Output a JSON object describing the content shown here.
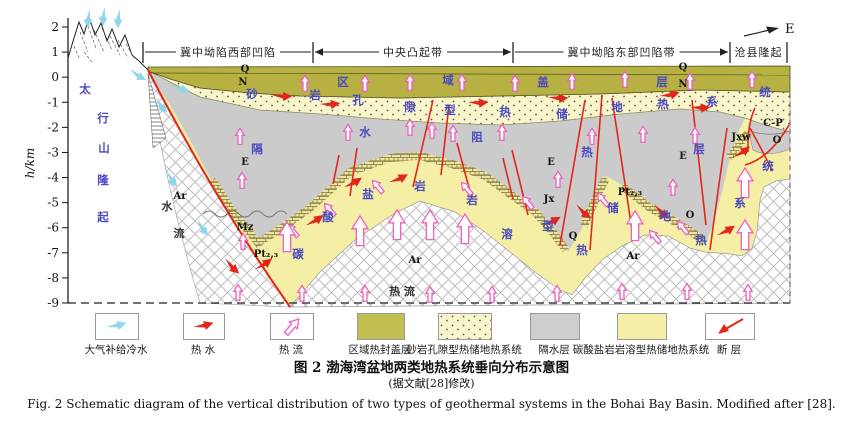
{
  "figure": {
    "caption_cn": "图 2  渤海湾盆地两类地热系统垂向分布示意图",
    "caption_note": "(据文献[28]修改)",
    "caption_en": "Fig. 2   Schematic diagram of the vertical distribution of two types of geothermal systems in the Bohai Bay Basin. Modified after [28]."
  },
  "axis": {
    "label": "h/km",
    "ticks": [
      "2",
      "1",
      "0",
      "-1",
      "-2",
      "-3",
      "-4",
      "-5",
      "-6",
      "-7",
      "-8",
      "-9"
    ]
  },
  "compass_label": "E",
  "zones": [
    {
      "label": "冀中坳陷西部凹陷",
      "x1": 143,
      "x2": 313,
      "arrow_left": false,
      "arrow_right": false
    },
    {
      "label": "中央凸起带",
      "x1": 313,
      "x2": 513,
      "arrow_left": true,
      "arrow_right": true
    },
    {
      "label": "冀中坳陷东部凹陷带",
      "x1": 513,
      "x2": 730,
      "arrow_left": false,
      "arrow_right": true
    },
    {
      "label": "沧县隆起",
      "x1": 730,
      "x2": 787,
      "arrow_left": false,
      "arrow_right": false
    }
  ],
  "zone_bars": [
    143,
    313,
    513,
    730,
    787
  ],
  "layer_phrases": {
    "cap_layer": "区域盖层",
    "sandstone_system": "砂岩孔隙型热储地热系统",
    "aquitard": "隔水阻热层",
    "karst_system": "碳酸盐岩岩溶型热储地热系统",
    "mountain": "太行山隆起",
    "heat_flow": "热 流",
    "water_flow": "水流"
  },
  "blue_labels": [
    {
      "t": "区",
      "x": 343,
      "y": 86
    },
    {
      "t": "域",
      "x": 448,
      "y": 84
    },
    {
      "t": "盖",
      "x": 543,
      "y": 86
    },
    {
      "t": "层",
      "x": 662,
      "y": 86
    },
    {
      "t": "砂",
      "x": 252,
      "y": 98
    },
    {
      "t": "岩",
      "x": 315,
      "y": 99
    },
    {
      "t": "孔",
      "x": 358,
      "y": 104
    },
    {
      "t": "隙",
      "x": 410,
      "y": 111
    },
    {
      "t": "型",
      "x": 450,
      "y": 114
    },
    {
      "t": "热",
      "x": 505,
      "y": 116
    },
    {
      "t": "储",
      "x": 562,
      "y": 118
    },
    {
      "t": "地",
      "x": 617,
      "y": 111
    },
    {
      "t": "热",
      "x": 663,
      "y": 108
    },
    {
      "t": "系",
      "x": 712,
      "y": 106
    },
    {
      "t": "统",
      "x": 765,
      "y": 96
    },
    {
      "t": "隔",
      "x": 257,
      "y": 153
    },
    {
      "t": "水",
      "x": 365,
      "y": 136
    },
    {
      "t": "阻",
      "x": 477,
      "y": 141
    },
    {
      "t": "热",
      "x": 587,
      "y": 156
    },
    {
      "t": "层",
      "x": 699,
      "y": 153
    },
    {
      "t": "碳",
      "x": 298,
      "y": 258
    },
    {
      "t": "酸",
      "x": 328,
      "y": 221
    },
    {
      "t": "盐",
      "x": 368,
      "y": 198
    },
    {
      "t": "岩",
      "x": 420,
      "y": 190
    },
    {
      "t": "岩",
      "x": 472,
      "y": 204
    },
    {
      "t": "溶",
      "x": 507,
      "y": 238
    },
    {
      "t": "型",
      "x": 548,
      "y": 230
    },
    {
      "t": "热",
      "x": 582,
      "y": 254
    },
    {
      "t": "储",
      "x": 613,
      "y": 212
    },
    {
      "t": "地",
      "x": 665,
      "y": 220
    },
    {
      "t": "热",
      "x": 701,
      "y": 244
    },
    {
      "t": "系",
      "x": 740,
      "y": 207
    },
    {
      "t": "统",
      "x": 768,
      "y": 170
    },
    {
      "t": "太",
      "x": 85,
      "y": 93
    },
    {
      "t": "行",
      "x": 103,
      "y": 122
    },
    {
      "t": "山",
      "x": 104,
      "y": 152
    },
    {
      "t": "隆",
      "x": 103,
      "y": 184
    },
    {
      "t": "起",
      "x": 103,
      "y": 221
    }
  ],
  "strat_labels": [
    {
      "t": "Q",
      "x": 245,
      "y": 72
    },
    {
      "t": "N",
      "x": 243,
      "y": 85
    },
    {
      "t": "Q",
      "x": 683,
      "y": 70
    },
    {
      "t": "N",
      "x": 683,
      "y": 87
    },
    {
      "t": "E",
      "x": 245,
      "y": 165
    },
    {
      "t": "E",
      "x": 551,
      "y": 165
    },
    {
      "t": "E",
      "x": 683,
      "y": 159
    },
    {
      "t": "Mz",
      "x": 245,
      "y": 230
    },
    {
      "t": "Ar",
      "x": 180,
      "y": 199
    },
    {
      "t": "Ar",
      "x": 415,
      "y": 263
    },
    {
      "t": "Ar",
      "x": 633,
      "y": 259
    },
    {
      "t": "Pt₂,₃",
      "x": 630,
      "y": 195
    },
    {
      "t": "Pt₂,₃",
      "x": 266,
      "y": 257
    },
    {
      "t": "Jxw",
      "x": 741,
      "y": 140
    },
    {
      "t": "C-P",
      "x": 773,
      "y": 126
    },
    {
      "t": "O",
      "x": 777,
      "y": 143
    },
    {
      "t": "O",
      "x": 690,
      "y": 218
    },
    {
      "t": "Q",
      "x": 573,
      "y": 239
    },
    {
      "t": "Jx",
      "x": 549,
      "y": 202
    }
  ],
  "dark_labels": [
    {
      "t": "水",
      "x": 167,
      "y": 210
    },
    {
      "t": "流",
      "x": 179,
      "y": 237
    },
    {
      "t": "热 流",
      "x": 402,
      "y": 295
    }
  ],
  "arrows": {
    "cyan": [
      [
        88,
        9,
        90
      ],
      [
        103,
        7,
        90
      ],
      [
        118,
        9,
        90
      ],
      [
        129,
        71,
        28
      ],
      [
        154,
        99,
        45
      ],
      [
        171,
        87,
        12
      ],
      [
        165,
        172,
        50
      ],
      [
        196,
        221,
        50
      ]
    ],
    "red": [
      [
        272,
        97,
        -2
      ],
      [
        320,
        106,
        -8
      ],
      [
        468,
        104,
        -5
      ],
      [
        548,
        99,
        -3
      ],
      [
        660,
        98,
        -16
      ],
      [
        690,
        109,
        -5
      ],
      [
        307,
        227,
        -36
      ],
      [
        345,
        189,
        -34
      ],
      [
        390,
        184,
        -28
      ],
      [
        543,
        227,
        -30
      ],
      [
        575,
        206,
        38
      ],
      [
        653,
        206,
        38
      ],
      [
        718,
        237,
        -34
      ],
      [
        224,
        260,
        42
      ],
      [
        256,
        271,
        -38
      ],
      [
        734,
        159,
        -38
      ]
    ],
    "pink_small": [
      [
        305,
        84
      ],
      [
        365,
        84
      ],
      [
        410,
        83
      ],
      [
        462,
        83
      ],
      [
        515,
        84
      ],
      [
        572,
        82
      ],
      [
        625,
        80
      ],
      [
        690,
        82
      ],
      [
        752,
        80
      ],
      [
        240,
        137
      ],
      [
        348,
        133
      ],
      [
        410,
        128
      ],
      [
        432,
        131
      ],
      [
        453,
        134
      ],
      [
        502,
        133
      ],
      [
        592,
        137
      ],
      [
        643,
        135
      ],
      [
        695,
        136
      ],
      [
        242,
        181
      ],
      [
        558,
        180
      ],
      [
        673,
        188
      ],
      [
        243,
        242
      ],
      [
        293,
        231,
        -40
      ],
      [
        330,
        210,
        -40
      ],
      [
        378,
        187,
        -40
      ],
      [
        467,
        189,
        -40
      ],
      [
        528,
        203,
        -40
      ],
      [
        603,
        200,
        -40
      ],
      [
        655,
        237,
        -40
      ],
      [
        683,
        228,
        -40
      ],
      [
        238,
        293
      ],
      [
        302,
        294
      ],
      [
        365,
        294
      ],
      [
        430,
        295
      ],
      [
        492,
        295
      ],
      [
        557,
        294
      ],
      [
        622,
        292
      ],
      [
        687,
        292
      ],
      [
        748,
        293
      ]
    ],
    "pink_big": [
      [
        360,
        232
      ],
      [
        397,
        226
      ],
      [
        430,
        226
      ],
      [
        465,
        230
      ],
      [
        635,
        227
      ],
      [
        745,
        184
      ],
      [
        745,
        236
      ],
      [
        287,
        238
      ]
    ]
  },
  "legend": [
    {
      "type": "arrow-cyan",
      "label": "大气补给冷水"
    },
    {
      "type": "arrow-red",
      "label": "热 水"
    },
    {
      "type": "arrow-pink",
      "label": "热 流"
    },
    {
      "type": "fill-olive",
      "label": "区域热封盖层"
    },
    {
      "type": "fill-dotted",
      "label": "砂岩孔隙型热储地热系统"
    },
    {
      "type": "fill-gray",
      "label": "隔水层"
    },
    {
      "type": "fill-yellow",
      "label": "碳酸盐岩岩溶型热储地热系统"
    },
    {
      "type": "fault",
      "label": "断 层"
    }
  ],
  "colors": {
    "olive_cap": "#b6b142",
    "sandstone_bg": "#f9f5cc",
    "aquitard_gray": "#cbcbcb",
    "karst_yellow": "#f5efa6",
    "fault_red": "#e3261a",
    "heat_pink": "#ee5fc0",
    "cold_cyan": "#8ed5ee",
    "label_blue": "#4a4ac0"
  }
}
